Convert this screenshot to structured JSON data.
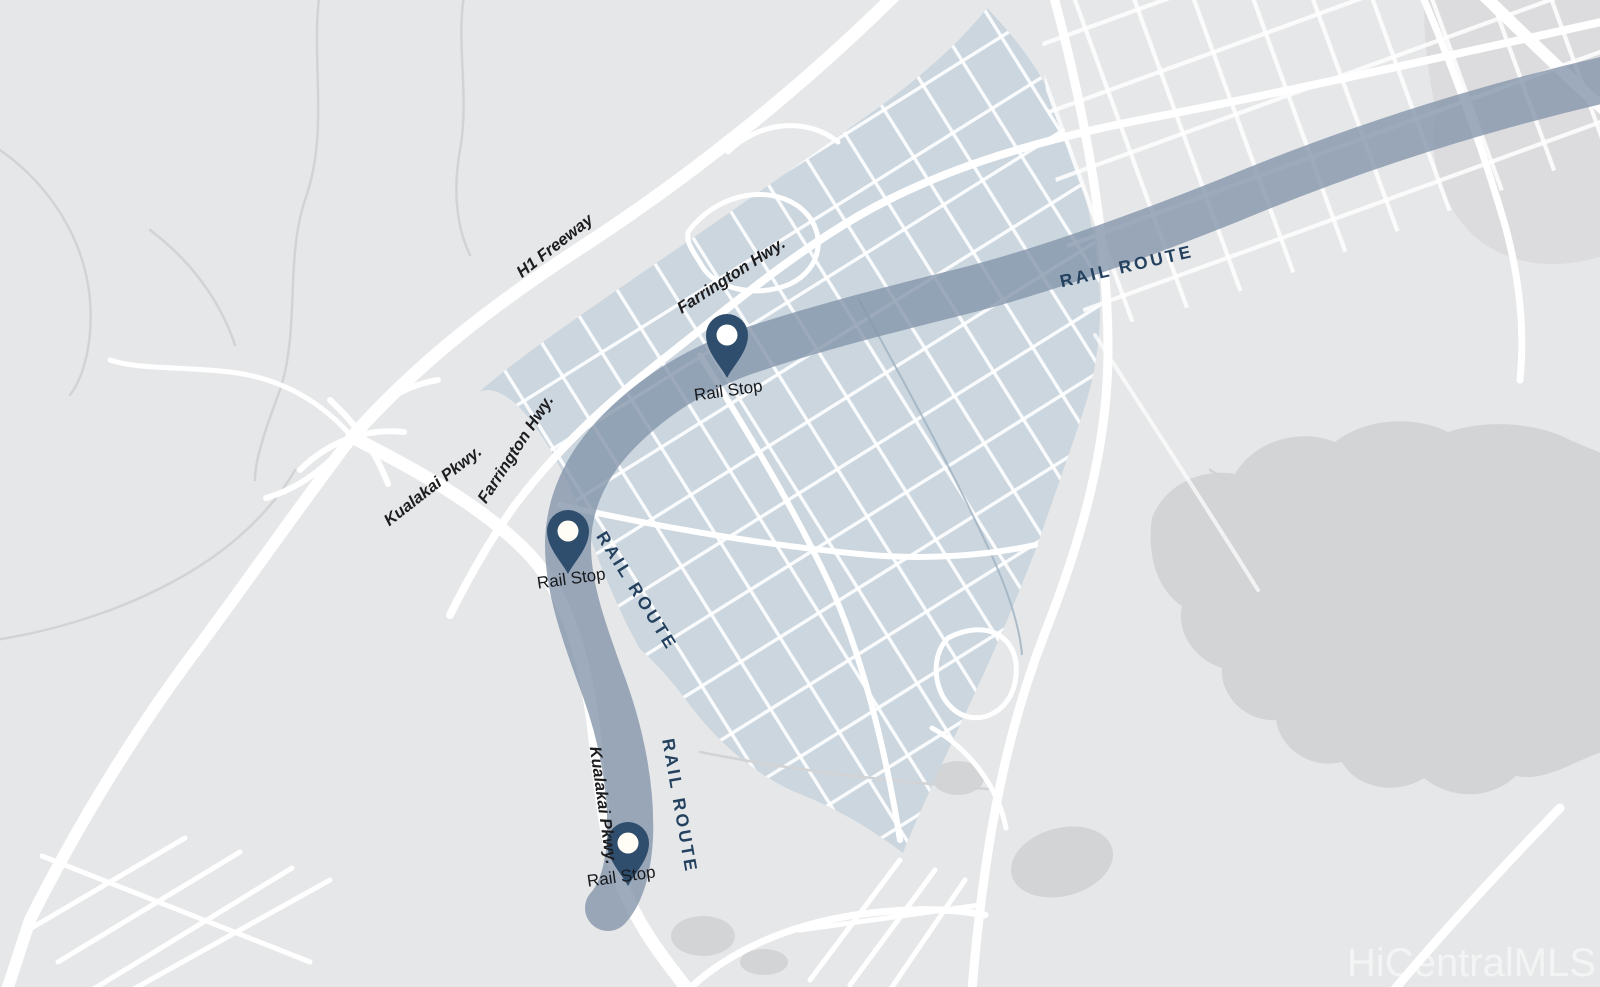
{
  "map": {
    "type": "rail-route-area-map",
    "watermark": "HiCentralMLS",
    "roads": {
      "h1_freeway": "H1 Freeway",
      "farrington_hwy_upper": "Farrington Hwy.",
      "farrington_hwy_lower": "Farrington Hwy.",
      "kualakai_pkwy_upper": "Kualakai Pkwy.",
      "kualakai_pkwy_lower": "Kualakai Pkwy."
    },
    "rail": {
      "route_label_upper": "RAIL ROUTE",
      "route_label_middle": "RAIL ROUTE",
      "route_label_lower": "RAIL ROUTE",
      "stops": [
        {
          "label": "Rail Stop"
        },
        {
          "label": "Rail Stop"
        },
        {
          "label": "Rail Stop"
        }
      ]
    },
    "colors": {
      "background": "#e6e7e8",
      "terrain_shade": "#d3d4d6",
      "highlight_area": "#cbd6df",
      "rail_route_band": "#8496ab",
      "pin_fill": "#2f4d6d",
      "pin_dot": "#ffffff",
      "rail_label_text": "#24415f",
      "road_label_text": "#1d1d1f",
      "road_fill": "#ffffff",
      "watermark_text": "#ffffff"
    }
  }
}
